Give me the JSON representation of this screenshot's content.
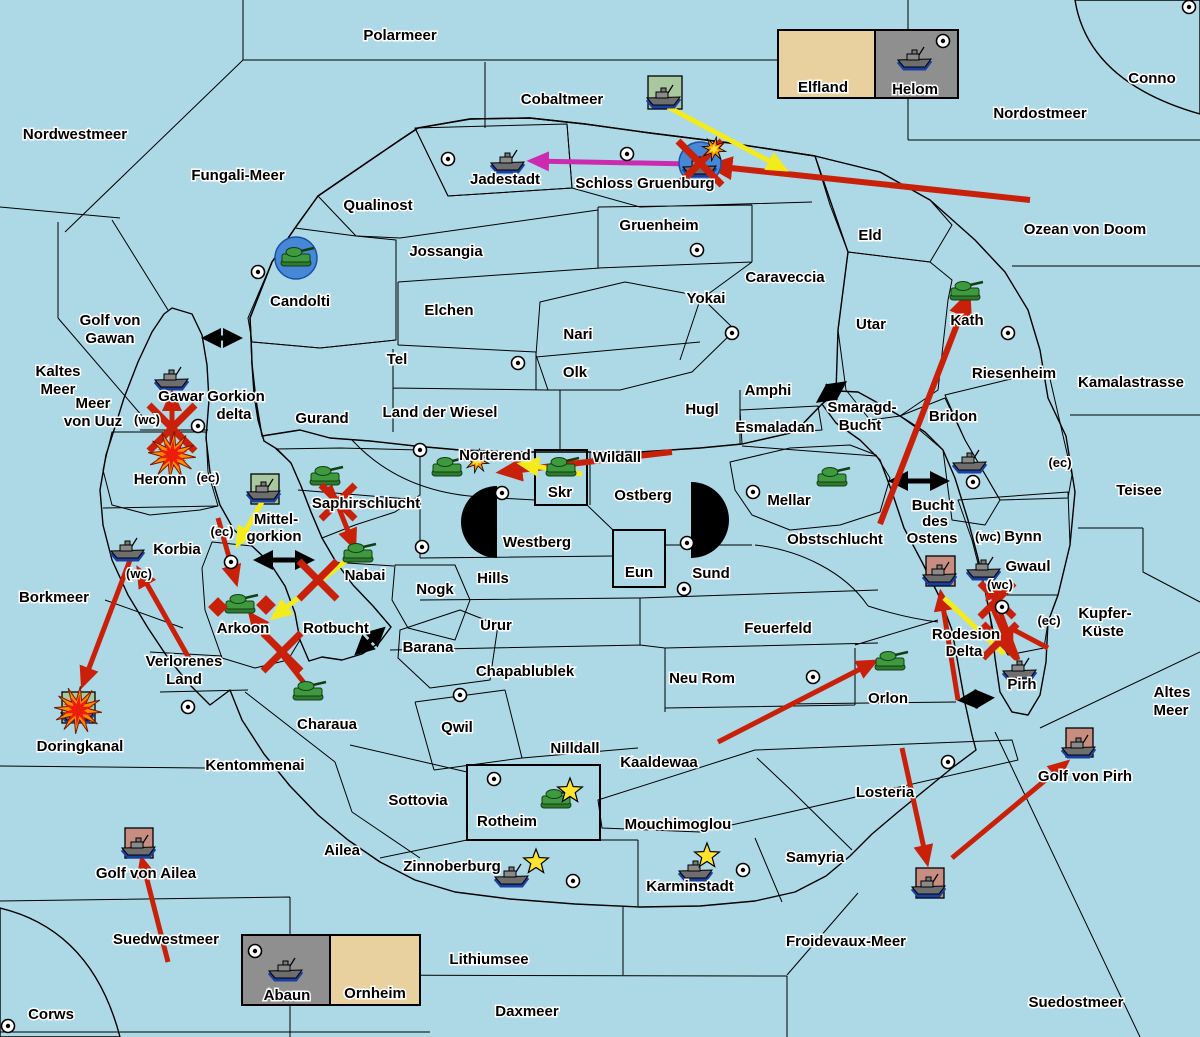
{
  "map_title": "Kriegskarte",
  "colors": {
    "sea": "#ADD8E6",
    "land_red": "#C68D80",
    "land_green": "#A8C8A0",
    "land_tan": "#E8D19E",
    "land_gray": "#8F8F8F",
    "arrow_red": "#C9200A",
    "arrow_yellow": "#F3EB1C",
    "arrow_magenta": "#CC2BAF",
    "arrow_black": "#000000",
    "dislodged_blue": "#4687D8",
    "star_yellow": "#FFE32E",
    "explosion_red": "#EE1C0C",
    "explosion_orange": "#FF8C00"
  },
  "labels": [
    {
      "t": "Polarmeer",
      "x": 400,
      "y": 40
    },
    {
      "t": "Cobaltmeer",
      "x": 562,
      "y": 104
    },
    {
      "t": "Nordwestmeer",
      "x": 75,
      "y": 139
    },
    {
      "t": "Fungali-Meer",
      "x": 238,
      "y": 180
    },
    {
      "t": "Nordostmeer",
      "x": 1040,
      "y": 118
    },
    {
      "t": "Conno",
      "x": 1152,
      "y": 83
    },
    {
      "t": "Ozean von Doom",
      "x": 1085,
      "y": 234
    },
    {
      "t": "Kamalastrasse",
      "x": 1131,
      "y": 387
    },
    {
      "t": "Teisee",
      "x": 1139,
      "y": 495
    },
    {
      "t": "Golf von",
      "x": 110,
      "y": 325
    },
    {
      "t": "Gawan",
      "x": 110,
      "y": 343
    },
    {
      "t": "Kaltes",
      "x": 58,
      "y": 376
    },
    {
      "t": "Meer",
      "x": 58,
      "y": 394
    },
    {
      "t": "Meer",
      "x": 93,
      "y": 408
    },
    {
      "t": "von Uuz",
      "x": 93,
      "y": 426
    },
    {
      "t": "Borkmeer",
      "x": 54,
      "y": 602
    },
    {
      "t": "Doringkanal",
      "x": 80,
      "y": 751
    },
    {
      "t": "Golf von Ailea",
      "x": 146,
      "y": 878
    },
    {
      "t": "Suedwestmeer",
      "x": 166,
      "y": 944
    },
    {
      "t": "Corws",
      "x": 51,
      "y": 1019
    },
    {
      "t": "Lithiumsee",
      "x": 489,
      "y": 964
    },
    {
      "t": "Daxmeer",
      "x": 527,
      "y": 1016
    },
    {
      "t": "Froidevaux-Meer",
      "x": 846,
      "y": 946
    },
    {
      "t": "Suedostmeer",
      "x": 1076,
      "y": 1007
    },
    {
      "t": "Golf von Pirh",
      "x": 1085,
      "y": 781
    },
    {
      "t": "Altes",
      "x": 1172,
      "y": 697
    },
    {
      "t": "Meer",
      "x": 1171,
      "y": 715
    },
    {
      "t": "Kupfer-",
      "x": 1105,
      "y": 618
    },
    {
      "t": "Küste",
      "x": 1103,
      "y": 636
    },
    {
      "t": "Gorkion",
      "x": 236,
      "y": 401
    },
    {
      "t": "delta",
      "x": 234,
      "y": 419
    },
    {
      "t": "Mittel-",
      "x": 276,
      "y": 524
    },
    {
      "t": "gorkion",
      "x": 274,
      "y": 541
    },
    {
      "t": "Smaragd-",
      "x": 862,
      "y": 412
    },
    {
      "t": "Bucht",
      "x": 860,
      "y": 430
    },
    {
      "t": "Bucht",
      "x": 933,
      "y": 510
    },
    {
      "t": "des",
      "x": 935,
      "y": 526
    },
    {
      "t": "Ostens",
      "x": 932,
      "y": 543
    },
    {
      "t": "Rodesion",
      "x": 966,
      "y": 639
    },
    {
      "t": "Delta",
      "x": 964,
      "y": 656
    },
    {
      "t": "Rotbucht",
      "x": 336,
      "y": 633
    },
    {
      "t": "Jadestadt",
      "x": 505,
      "y": 184
    },
    {
      "t": "Schloss Gruenburg",
      "x": 645,
      "y": 188
    },
    {
      "t": "Qualinost",
      "x": 378,
      "y": 210
    },
    {
      "t": "Gruenheim",
      "x": 659,
      "y": 230
    },
    {
      "t": "Jossangia",
      "x": 446,
      "y": 256
    },
    {
      "t": "Elchen",
      "x": 449,
      "y": 315
    },
    {
      "t": "Caraveccia",
      "x": 785,
      "y": 282
    },
    {
      "t": "Yokai",
      "x": 706,
      "y": 303
    },
    {
      "t": "Eld",
      "x": 870,
      "y": 240
    },
    {
      "t": "Utar",
      "x": 871,
      "y": 329
    },
    {
      "t": "Kath",
      "x": 967,
      "y": 325
    },
    {
      "t": "Nari",
      "x": 578,
      "y": 339
    },
    {
      "t": "Tel",
      "x": 397,
      "y": 364
    },
    {
      "t": "Olk",
      "x": 575,
      "y": 377
    },
    {
      "t": "Riesenheim",
      "x": 1014,
      "y": 378
    },
    {
      "t": "Bridon",
      "x": 953,
      "y": 421
    },
    {
      "t": "Bynn",
      "x": 1023,
      "y": 541
    },
    {
      "t": "Gwaul",
      "x": 1028,
      "y": 571
    },
    {
      "t": "Gurand",
      "x": 322,
      "y": 423
    },
    {
      "t": "Land der Wiesel",
      "x": 440,
      "y": 417
    },
    {
      "t": "Hugl",
      "x": 702,
      "y": 414
    },
    {
      "t": "Amphi",
      "x": 768,
      "y": 395
    },
    {
      "t": "Esmaladan",
      "x": 775,
      "y": 432
    },
    {
      "t": "Candolti",
      "x": 300,
      "y": 306
    },
    {
      "t": "Gawar",
      "x": 181,
      "y": 401
    },
    {
      "t": "Heronn",
      "x": 160,
      "y": 484
    },
    {
      "t": "Korbia",
      "x": 177,
      "y": 554
    },
    {
      "t": "Saphirschlucht",
      "x": 366,
      "y": 508
    },
    {
      "t": "Nabai",
      "x": 365,
      "y": 580
    },
    {
      "t": "Arkoon",
      "x": 243,
      "y": 633
    },
    {
      "t": "Verlorenes",
      "x": 184,
      "y": 666
    },
    {
      "t": "Land",
      "x": 184,
      "y": 684
    },
    {
      "t": "Kentommenai",
      "x": 255,
      "y": 770
    },
    {
      "t": "Charaua",
      "x": 327,
      "y": 729
    },
    {
      "t": "Sottovia",
      "x": 418,
      "y": 805
    },
    {
      "t": "Ailea",
      "x": 342,
      "y": 855
    },
    {
      "t": "Norterend",
      "x": 495,
      "y": 460
    },
    {
      "t": "Wildall",
      "x": 617,
      "y": 462
    },
    {
      "t": "Skr",
      "x": 560,
      "y": 497
    },
    {
      "t": "Ostberg",
      "x": 643,
      "y": 500
    },
    {
      "t": "Westberg",
      "x": 537,
      "y": 547
    },
    {
      "t": "Hills",
      "x": 493,
      "y": 583
    },
    {
      "t": "Eun",
      "x": 639,
      "y": 577
    },
    {
      "t": "Sund",
      "x": 711,
      "y": 578
    },
    {
      "t": "Urur",
      "x": 496,
      "y": 630
    },
    {
      "t": "Feuerfeld",
      "x": 778,
      "y": 633
    },
    {
      "t": "Nogk",
      "x": 435,
      "y": 594
    },
    {
      "t": "Barana",
      "x": 428,
      "y": 652
    },
    {
      "t": "Chapablublek",
      "x": 525,
      "y": 676
    },
    {
      "t": "Neu Rom",
      "x": 702,
      "y": 683
    },
    {
      "t": "Qwil",
      "x": 457,
      "y": 732
    },
    {
      "t": "Nilldall",
      "x": 575,
      "y": 753
    },
    {
      "t": "Kaaldewaa",
      "x": 659,
      "y": 767
    },
    {
      "t": "Mouchimoglou",
      "x": 678,
      "y": 829
    },
    {
      "t": "Rotheim",
      "x": 507,
      "y": 826
    },
    {
      "t": "Zinnoberburg",
      "x": 452,
      "y": 871
    },
    {
      "t": "Karminstadt",
      "x": 690,
      "y": 891
    },
    {
      "t": "Samyria",
      "x": 815,
      "y": 862
    },
    {
      "t": "Losteria",
      "x": 885,
      "y": 797
    },
    {
      "t": "Orlon",
      "x": 888,
      "y": 703
    },
    {
      "t": "Obstschlucht",
      "x": 835,
      "y": 544
    },
    {
      "t": "Mellar",
      "x": 789,
      "y": 505
    },
    {
      "t": "Pirh",
      "x": 1022,
      "y": 689
    },
    {
      "t": "Elfland",
      "x": 823,
      "y": 92
    },
    {
      "t": "Helom",
      "x": 915,
      "y": 94
    },
    {
      "t": "Abaun",
      "x": 287,
      "y": 1000
    },
    {
      "t": "Ornheim",
      "x": 375,
      "y": 998
    },
    {
      "t": "(wc)",
      "x": 147,
      "y": 424,
      "s": 13
    },
    {
      "t": "(ec)",
      "x": 208,
      "y": 482,
      "s": 13
    },
    {
      "t": "(ec)",
      "x": 222,
      "y": 536,
      "s": 13
    },
    {
      "t": "(wc)",
      "x": 139,
      "y": 578,
      "s": 13
    },
    {
      "t": "(ec)",
      "x": 1060,
      "y": 467,
      "s": 13
    },
    {
      "t": "(wc)",
      "x": 988,
      "y": 541,
      "s": 13
    },
    {
      "t": "(wc)",
      "x": 1000,
      "y": 589,
      "s": 13
    },
    {
      "t": "(ec)",
      "x": 1049,
      "y": 625,
      "s": 13
    }
  ],
  "supply_centers": [
    [
      448,
      159
    ],
    [
      627,
      154
    ],
    [
      697,
      250
    ],
    [
      732,
      333
    ],
    [
      518,
      363
    ],
    [
      258,
      272
    ],
    [
      1008,
      333
    ],
    [
      973,
      482
    ],
    [
      1002,
      607
    ],
    [
      943,
      41
    ],
    [
      1189,
      7
    ],
    [
      198,
      426
    ],
    [
      420,
      450
    ],
    [
      502,
      493
    ],
    [
      422,
      547
    ],
    [
      687,
      543
    ],
    [
      684,
      589
    ],
    [
      753,
      492
    ],
    [
      231,
      562
    ],
    [
      188,
      707
    ],
    [
      460,
      695
    ],
    [
      813,
      677
    ],
    [
      948,
      762
    ],
    [
      494,
      779
    ],
    [
      573,
      881
    ],
    [
      743,
      870
    ],
    [
      8,
      1026
    ],
    [
      255,
      951
    ]
  ],
  "units": [
    {
      "t": "f",
      "x": 664,
      "y": 95
    },
    {
      "t": "f",
      "x": 508,
      "y": 160
    },
    {
      "t": "f",
      "x": 700,
      "y": 164
    },
    {
      "t": "f",
      "x": 915,
      "y": 57
    },
    {
      "t": "a",
      "x": 296,
      "y": 258
    },
    {
      "t": "f",
      "x": 172,
      "y": 377
    },
    {
      "t": "a",
      "x": 965,
      "y": 292
    },
    {
      "t": "f",
      "x": 970,
      "y": 460
    },
    {
      "t": "a",
      "x": 325,
      "y": 477
    },
    {
      "t": "f",
      "x": 264,
      "y": 489
    },
    {
      "t": "a",
      "x": 447,
      "y": 468
    },
    {
      "t": "a",
      "x": 561,
      "y": 468
    },
    {
      "t": "a",
      "x": 358,
      "y": 554
    },
    {
      "t": "f",
      "x": 128,
      "y": 548
    },
    {
      "t": "a",
      "x": 240,
      "y": 605
    },
    {
      "t": "a",
      "x": 832,
      "y": 478
    },
    {
      "t": "f",
      "x": 984,
      "y": 567
    },
    {
      "t": "f",
      "x": 940,
      "y": 572
    },
    {
      "t": "f",
      "x": 1020,
      "y": 668
    },
    {
      "t": "a",
      "x": 890,
      "y": 662
    },
    {
      "t": "a",
      "x": 308,
      "y": 692
    },
    {
      "t": "f",
      "x": 78,
      "y": 710
    },
    {
      "t": "a",
      "x": 556,
      "y": 800
    },
    {
      "t": "f",
      "x": 512,
      "y": 874
    },
    {
      "t": "f",
      "x": 696,
      "y": 868
    },
    {
      "t": "f",
      "x": 139,
      "y": 845
    },
    {
      "t": "f",
      "x": 1079,
      "y": 745
    },
    {
      "t": "f",
      "x": 929,
      "y": 884
    },
    {
      "t": "f",
      "x": 286,
      "y": 968
    }
  ],
  "unit_boxes": [
    {
      "x": 648,
      "y": 76,
      "w": 34,
      "h": 33,
      "c": "green"
    },
    {
      "x": 251,
      "y": 474,
      "w": 28,
      "h": 30,
      "c": "green"
    },
    {
      "x": 62,
      "y": 692,
      "w": 33,
      "h": 31,
      "c": "green"
    },
    {
      "x": 926,
      "y": 556,
      "w": 29,
      "h": 30,
      "c": "red"
    },
    {
      "x": 125,
      "y": 828,
      "w": 28,
      "h": 30,
      "c": "red"
    },
    {
      "x": 1066,
      "y": 728,
      "w": 27,
      "h": 29,
      "c": "red"
    },
    {
      "x": 916,
      "y": 868,
      "w": 28,
      "h": 30,
      "c": "red"
    }
  ],
  "arrows": [
    {
      "c": "r",
      "p": [
        1030,
        200,
        712,
        166
      ],
      "h": 1,
      "w": 6
    },
    {
      "c": "r",
      "p": [
        880,
        524,
        968,
        296
      ],
      "h": 1,
      "w": 6
    },
    {
      "c": "r",
      "p": [
        672,
        452,
        502,
        472
      ],
      "h": 1,
      "w": 6
    },
    {
      "c": "r",
      "p": [
        330,
        486,
        354,
        546
      ],
      "h": 1,
      "w": 5
    },
    {
      "c": "r",
      "p": [
        172,
        452,
        172,
        394
      ],
      "h": 1,
      "w": 5
    },
    {
      "c": "r",
      "p": [
        130,
        560,
        83,
        684
      ],
      "h": 1,
      "w": 5
    },
    {
      "c": "r",
      "p": [
        190,
        660,
        139,
        570
      ],
      "h": 1,
      "w": 5
    },
    {
      "c": "r",
      "p": [
        218,
        518,
        236,
        582
      ],
      "h": 1,
      "w": 5
    },
    {
      "c": "r",
      "p": [
        308,
        688,
        251,
        615
      ],
      "h": 1,
      "w": 5
    },
    {
      "c": "r",
      "p": [
        718,
        742,
        874,
        662
      ],
      "h": 1,
      "w": 5
    },
    {
      "c": "r",
      "p": [
        902,
        748,
        927,
        862
      ],
      "h": 1,
      "w": 5
    },
    {
      "c": "r",
      "p": [
        952,
        858,
        1066,
        763
      ],
      "h": 1,
      "w": 5
    },
    {
      "c": "r",
      "p": [
        958,
        700,
        941,
        594
      ],
      "h": 1,
      "w": 5
    },
    {
      "c": "r",
      "p": [
        1018,
        660,
        989,
        582
      ],
      "h": 1,
      "w": 5
    },
    {
      "c": "r",
      "p": [
        990,
        602,
        1011,
        650
      ],
      "h": 1,
      "w": 5
    },
    {
      "c": "r",
      "p": [
        168,
        962,
        142,
        860
      ],
      "h": 1,
      "w": 5
    },
    {
      "c": "r",
      "p": [
        1048,
        648,
        1014,
        630
      ],
      "h": 0,
      "w": 5
    },
    {
      "c": "y",
      "p": [
        668,
        107,
        784,
        169
      ],
      "h": 1,
      "w": 5
    },
    {
      "c": "y",
      "p": [
        582,
        474,
        522,
        464
      ],
      "h": 1,
      "w": 5
    },
    {
      "c": "y",
      "p": [
        262,
        502,
        238,
        544
      ],
      "h": 1,
      "w": 5
    },
    {
      "c": "y",
      "p": [
        352,
        556,
        274,
        617
      ],
      "h": 1,
      "w": 5
    },
    {
      "c": "y",
      "p": [
        944,
        598,
        1004,
        654
      ],
      "h": 0,
      "w": 5
    },
    {
      "c": "m",
      "p": [
        692,
        164,
        532,
        161
      ],
      "h": 1,
      "w": 5
    }
  ],
  "crosses": [
    {
      "x": 338,
      "y": 502,
      "s": 17
    },
    {
      "x": 172,
      "y": 428,
      "s": 23
    },
    {
      "x": 318,
      "y": 580,
      "s": 19
    },
    {
      "x": 282,
      "y": 652,
      "s": 19
    },
    {
      "x": 997,
      "y": 600,
      "s": 17
    },
    {
      "x": 1000,
      "y": 641,
      "s": 17
    },
    {
      "x": 700,
      "y": 163,
      "s": 22
    }
  ],
  "double_arrows": [
    [
      206,
      338,
      238,
      338
    ],
    [
      258,
      560,
      310,
      560
    ],
    [
      358,
      652,
      382,
      630
    ],
    [
      820,
      400,
      843,
      384
    ],
    [
      893,
      481,
      945,
      481
    ],
    [
      962,
      700,
      990,
      698
    ]
  ],
  "explosions": [
    [
      172,
      455
    ],
    [
      78,
      710
    ]
  ],
  "sparks": [
    [
      714,
      149
    ],
    [
      477,
      461
    ]
  ],
  "stars": [
    [
      570,
      791
    ],
    [
      536,
      862
    ],
    [
      707,
      856
    ]
  ],
  "dislodged_circles": [
    [
      700,
      163
    ],
    [
      296,
      258
    ]
  ],
  "diamonds": [
    [
      218,
      607
    ],
    [
      266,
      605
    ]
  ]
}
